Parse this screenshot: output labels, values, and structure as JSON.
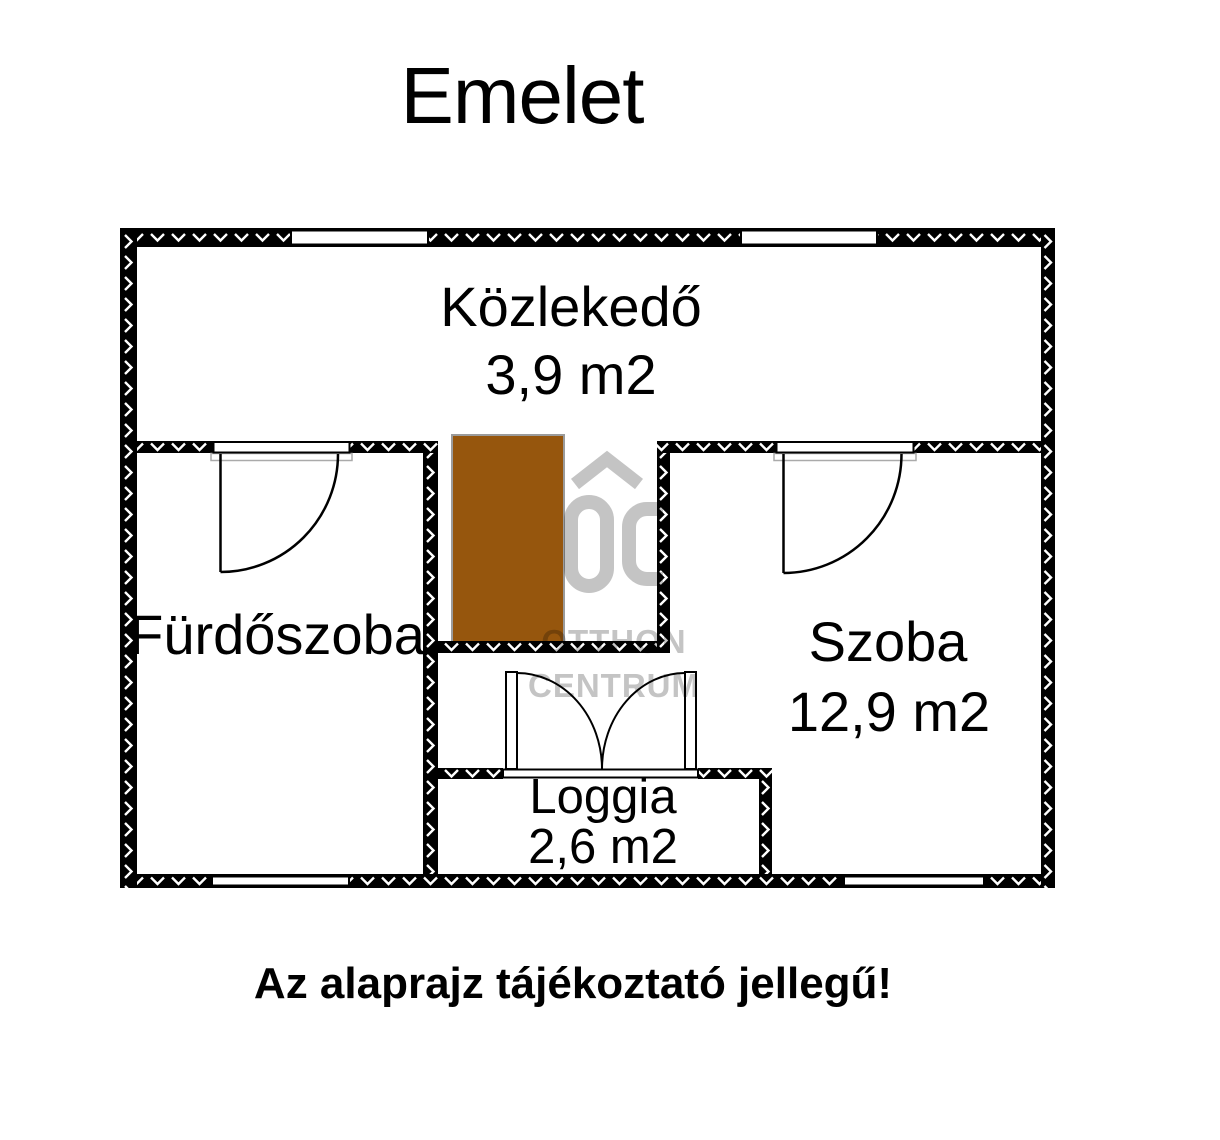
{
  "title": "Emelet",
  "caption": "Az alaprajz tájékoztató jellegű!",
  "rooms": {
    "kozlekedo": {
      "name": "Közlekedő",
      "area": "3,9 m2"
    },
    "furdoszoba": {
      "name": "Fürdőszoba"
    },
    "szoba": {
      "name": "Szoba",
      "area": "12,9 m2"
    },
    "loggia": {
      "name": "Loggia",
      "area": "2,6 m2"
    }
  },
  "watermark": {
    "brand_top": "OTTHON",
    "brand_bottom": "CENTRUM"
  },
  "colors": {
    "wall": "#000000",
    "wall_hatch": "#ffffff",
    "stairs_fill": "#96560d",
    "stairs_border": "#9b9b9b",
    "door_frame_gray": "#aaaaaa",
    "watermark_gray": "#c4c4c4",
    "background": "#ffffff"
  }
}
